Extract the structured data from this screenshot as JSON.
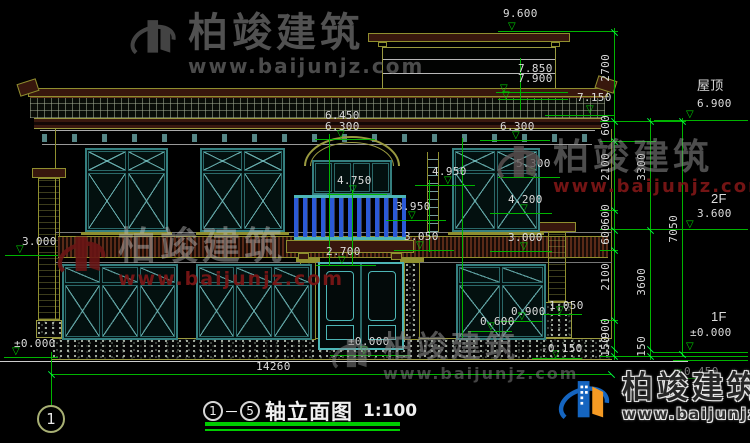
{
  "title_block": {
    "axis_from": "1",
    "dash": "－",
    "axis_to": "5",
    "name": "轴立面图",
    "scale": "1:100"
  },
  "axis_bubble": "1",
  "total_width_dim": "14260",
  "watermark_brand": "柏竣建筑",
  "watermark_url": "www.baijunjz.com",
  "colors": {
    "dim_green": "#00b400",
    "frame_teal": "#357f7f",
    "olive": "#8f8f2f",
    "maroon": "#38170d",
    "baluster_blue": "#2b59d6",
    "logo_blue": "#1565c0",
    "logo_orange": "#f59a23",
    "wm_red": "#7a1616"
  },
  "floor_marks": [
    {
      "label": "屋顶",
      "level": "6.900"
    },
    {
      "label": "2F",
      "level": "3.600"
    },
    {
      "label": "1F",
      "level": "±0.000"
    }
  ],
  "annotations": [
    {
      "n": "level-9600",
      "t": "9.600",
      "x": 503,
      "y": 8,
      "tri": [
        508,
        22
      ],
      "line": [
        498,
        31,
        120
      ]
    },
    {
      "n": "level-7850",
      "t": "7.850",
      "x": 518,
      "y": 63,
      "tri": [
        500,
        84
      ],
      "line": [
        496,
        92,
        72
      ]
    },
    {
      "n": "level-7900",
      "t": "7.900",
      "x": 518,
      "y": 73,
      "tri": [
        502,
        91
      ],
      "line": [
        498,
        99,
        70
      ]
    },
    {
      "n": "level-7150",
      "t": "7.150",
      "x": 577,
      "y": 92,
      "tri": [
        586,
        105
      ],
      "line": [
        545,
        115,
        70
      ]
    },
    {
      "n": "level-6450",
      "t": "6.450",
      "x": 325,
      "y": 110
    },
    {
      "n": "level-6300-c",
      "t": "6.300",
      "x": 325,
      "y": 121,
      "tri": [
        337,
        130
      ],
      "line": [
        315,
        139,
        60
      ]
    },
    {
      "n": "level-6300-r",
      "t": "6.300",
      "x": 500,
      "y": 121,
      "tri": [
        512,
        131
      ],
      "line": [
        480,
        140,
        70
      ]
    },
    {
      "n": "level-5300",
      "t": "5.300",
      "x": 516,
      "y": 158,
      "tri": [
        528,
        168
      ],
      "line": [
        498,
        177,
        62
      ]
    },
    {
      "n": "level-4950",
      "t": "4.950",
      "x": 432,
      "y": 166,
      "tri": [
        444,
        176
      ],
      "line": [
        415,
        185,
        60
      ]
    },
    {
      "n": "level-4750",
      "t": "4.750",
      "x": 337,
      "y": 175,
      "tri": [
        349,
        185
      ],
      "line": [
        327,
        194,
        60
      ]
    },
    {
      "n": "level-4200",
      "t": "4.200",
      "x": 508,
      "y": 194,
      "tri": [
        520,
        204
      ],
      "line": [
        490,
        213,
        62
      ]
    },
    {
      "n": "level-3950",
      "t": "3.950",
      "x": 396,
      "y": 201,
      "tri": [
        408,
        211
      ],
      "line": [
        386,
        220,
        60
      ]
    },
    {
      "n": "level-3050",
      "t": "3.050",
      "x": 404,
      "y": 231,
      "tri": [
        416,
        241
      ],
      "line": [
        394,
        250,
        60
      ]
    },
    {
      "n": "level-3000-r",
      "t": "3.000",
      "x": 508,
      "y": 232,
      "tri": [
        520,
        242
      ],
      "line": [
        490,
        251,
        62
      ]
    },
    {
      "n": "level-2700",
      "t": "2.700",
      "x": 326,
      "y": 246,
      "tri": [
        338,
        256
      ],
      "line": [
        316,
        265,
        60
      ]
    },
    {
      "n": "level-3000-l",
      "t": "3.000",
      "x": 22,
      "y": 236,
      "tri": [
        16,
        245
      ],
      "line": [
        5,
        255,
        53
      ]
    },
    {
      "n": "level-0000-l",
      "t": "±0.000",
      "x": 14,
      "y": 338,
      "tri": [
        12,
        347
      ],
      "line": [
        4,
        357,
        54
      ]
    },
    {
      "n": "level-0000-door",
      "t": "±0.000",
      "x": 348,
      "y": 336,
      "tri": [
        360,
        346
      ],
      "line": [
        330,
        355,
        80
      ]
    },
    {
      "n": "level-1050",
      "t": "1.050",
      "x": 549,
      "y": 300,
      "tri": [
        556,
        306
      ],
      "line": [
        540,
        314,
        42
      ]
    },
    {
      "n": "level-0900",
      "t": "0.900",
      "x": 511,
      "y": 306,
      "tri": [
        518,
        312
      ],
      "line": [
        500,
        321,
        42
      ]
    },
    {
      "n": "level-0600",
      "t": "0.600",
      "x": 480,
      "y": 316,
      "tri": [
        487,
        322
      ],
      "line": [
        468,
        331,
        44
      ]
    },
    {
      "n": "level-neg0150",
      "t": "-0.150",
      "x": 541,
      "y": 343,
      "tri": [
        552,
        350
      ],
      "line": [
        532,
        358,
        50
      ]
    },
    {
      "n": "level-0450",
      "t": "0.450",
      "x": 684,
      "y": 366,
      "tri": [
        674,
        369
      ],
      "line": [
        658,
        378,
        44
      ],
      "op": 0.55
    },
    {
      "n": "floor-roof-label",
      "t": "屋顶",
      "x": 697,
      "y": 80,
      "cjk": 1
    },
    {
      "n": "floor-roof-level",
      "t": "6.900",
      "x": 697,
      "y": 98,
      "tri": [
        686,
        110
      ],
      "line": [
        654,
        120,
        94
      ]
    },
    {
      "n": "floor-2f-label",
      "t": "2F",
      "x": 711,
      "y": 193,
      "cjk": 1
    },
    {
      "n": "floor-2f-level",
      "t": "3.600",
      "x": 697,
      "y": 208,
      "tri": [
        686,
        220
      ],
      "line": [
        654,
        229,
        94
      ]
    },
    {
      "n": "floor-1f-label",
      "t": "1F",
      "x": 711,
      "y": 311,
      "cjk": 1
    },
    {
      "n": "floor-1f-level",
      "t": "±0.000",
      "x": 690,
      "y": 327,
      "tri": [
        686,
        342
      ],
      "line": [
        654,
        352,
        94
      ]
    },
    {
      "n": "total-width",
      "t": "14260",
      "x": 256,
      "y": 361
    }
  ],
  "dim_chains": [
    {
      "x": 614,
      "y1": 28,
      "y2": 360,
      "ticks": [
        32,
        121,
        141,
        210,
        230,
        250,
        320,
        349,
        356
      ],
      "labels": [
        {
          "t": "2700",
          "y": 54
        },
        {
          "t": "600",
          "y": 115
        },
        {
          "t": "2100",
          "y": 153
        },
        {
          "t": "600",
          "y": 204
        },
        {
          "t": "600",
          "y": 224
        },
        {
          "t": "2100",
          "y": 263
        },
        {
          "t": "900",
          "y": 318
        },
        {
          "t": "150",
          "y": 336
        }
      ]
    },
    {
      "x": 650,
      "y1": 118,
      "y2": 360,
      "ticks": [
        121,
        230,
        349,
        356
      ],
      "labels": [
        {
          "t": "3300",
          "y": 153
        },
        {
          "t": "3600",
          "y": 268
        },
        {
          "t": "150",
          "y": 336
        }
      ]
    },
    {
      "x": 682,
      "y1": 118,
      "y2": 356,
      "ticks": [
        121,
        354
      ],
      "labels": [
        {
          "t": "7050",
          "y": 215
        }
      ]
    }
  ],
  "bottom_dim_line": {
    "x1": 51,
    "x2": 611,
    "y": 374
  },
  "watermarks": [
    {
      "n": "watermark-top",
      "x": 128,
      "y": 12,
      "logo": "#4f4f4f",
      "logoOp": 0.85,
      "logo2": "#4f4f4f",
      "size": 52,
      "brandC": "#5a5a5a",
      "brandOp": 0.9,
      "brandS": 40,
      "urlC": "#545454",
      "urlOp": 0.9,
      "urlS": 20
    },
    {
      "n": "watermark-mid-right",
      "x": 495,
      "y": 138,
      "logo": "#5f5353",
      "logoOp": 0.8,
      "logo2": "#5f5353",
      "size": 50,
      "brandC": "#9a9a9a",
      "brandOp": 0.5,
      "brandS": 36,
      "urlC": "#7a1616",
      "urlOp": 0.95,
      "urlS": 18
    },
    {
      "n": "watermark-mid-left",
      "x": 55,
      "y": 228,
      "logo": "#6b1515",
      "logoOp": 0.9,
      "logo2": "#6b1515",
      "size": 55,
      "brandC": "#bdbdbd",
      "brandOp": 0.45,
      "brandS": 38,
      "urlC": "#7a1616",
      "urlOp": 0.95,
      "urlS": 19
    },
    {
      "n": "watermark-bottom-center",
      "x": 330,
      "y": 332,
      "logo": "#8a8a8a",
      "logoOp": 0.5,
      "logo2": "#8a8a8a",
      "size": 45,
      "brandC": "#8a8a8a",
      "brandOp": 0.6,
      "brandS": 30,
      "urlC": "#8a8a8a",
      "urlOp": 0.5,
      "urlS": 16
    },
    {
      "n": "watermark-logo-corner",
      "x": 556,
      "y": 372,
      "logo": "#1565c0",
      "logoOp": 1,
      "logo2": "#f59a23",
      "size": 58,
      "brandC": "#262626",
      "brandOp": 1,
      "brandS": 31,
      "urlC": "#303030",
      "urlOp": 1,
      "urlS": 15,
      "outline": 1
    }
  ]
}
